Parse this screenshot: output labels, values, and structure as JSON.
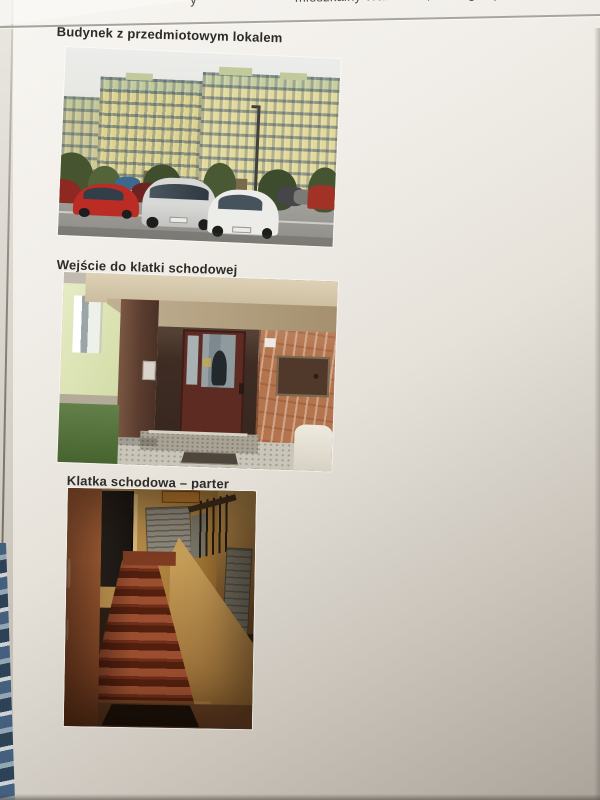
{
  "header": {
    "prefix_fragment": "y",
    "title_fragment": "mieszkalny Warszawa, ul. Zagłoby 5/52"
  },
  "figures": [
    {
      "caption": "Budynek z przedmiotowym lokalem",
      "photo": "apartment-building-exterior-with-parked-cars"
    },
    {
      "caption": "Wejście do klatki schodowej",
      "photo": "building-entrance-with-brown-door-and-brick-wall"
    },
    {
      "caption": "Klatka schodowa – parter",
      "photo": "interior-staircase-ground-floor-with-mailboxes"
    }
  ],
  "colors": {
    "page_top": "#f8f6f2",
    "page_bottom": "#aba49b",
    "caption_text": "#2d2b27",
    "header_text": "#4b4b47",
    "building_facade": "#ddd391",
    "building_green_band": "#c2ca9c",
    "entrance_brick": "#b3744e",
    "entrance_door": "#5d2b22",
    "stair_tread": "#9c4f30",
    "blue_object": "#44607e"
  }
}
